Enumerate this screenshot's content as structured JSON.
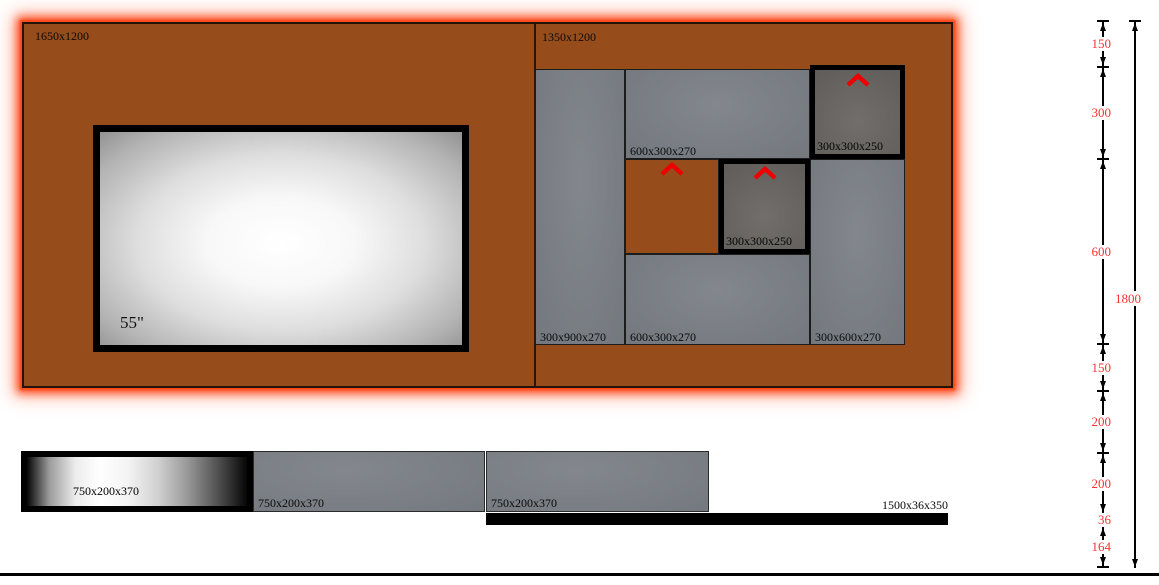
{
  "colors": {
    "wall": "#964d1b",
    "glow": "#ff4818",
    "panel_gray": "#7c8187",
    "speaker_gray": "#6c6965",
    "dim_red": "#ff3030",
    "chevron_red": "#ee0000"
  },
  "wall": {
    "left_section": {
      "label": "1650x1200"
    },
    "right_section": {
      "label": "1350x1200",
      "panels": {
        "col_left": {
          "label": "300x900x270"
        },
        "shelf_top": {
          "label": "600x300x270"
        },
        "speaker_top": {
          "label": "300x300x250"
        },
        "speaker_mid": {
          "label": "300x300x250"
        },
        "shelf_bottom": {
          "label": "600x300x270"
        },
        "col_right": {
          "label": "300x600x270"
        }
      }
    },
    "tv": {
      "label": "55\""
    }
  },
  "base": {
    "shelves": [
      {
        "label": "750x200x370"
      },
      {
        "label": "750x200x370"
      },
      {
        "label": "750x200x370"
      }
    ],
    "rail": {
      "label": "1500x36x350"
    }
  },
  "dimensions": {
    "segments": [
      {
        "value": "150"
      },
      {
        "value": "300"
      },
      {
        "value": "600"
      },
      {
        "value": "150"
      },
      {
        "value": "200"
      },
      {
        "value": "200"
      },
      {
        "value": "36"
      },
      {
        "value": "164"
      }
    ],
    "total": {
      "value": "1800"
    }
  }
}
